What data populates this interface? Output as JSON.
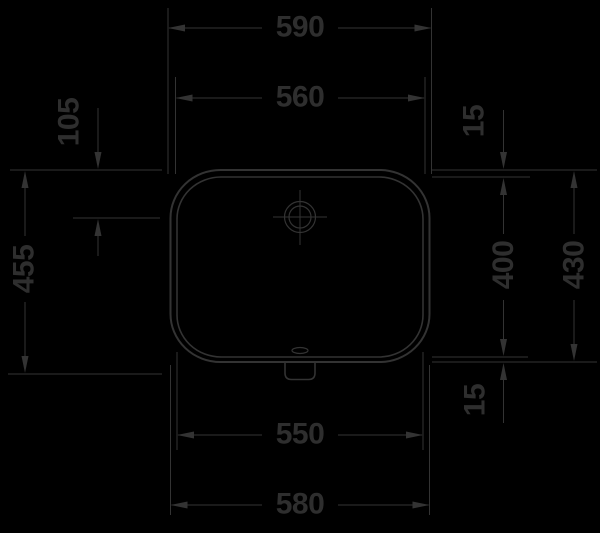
{
  "drawing": {
    "title": "Washbasin plan-view technical dimension drawing",
    "units": "mm",
    "colors": {
      "background": "#000000",
      "line": "#333333",
      "text": "#2e2e2e"
    },
    "labels": {
      "d590": "590",
      "d560": "560",
      "d550": "550",
      "d580": "580",
      "d455": "455",
      "d105": "105",
      "d400": "400",
      "d430": "430",
      "d15_top": "15",
      "d15_bottom": "15"
    },
    "dimensions_mm": {
      "top_width_outer": 590,
      "top_width_inner": 560,
      "bottom_width_inner": 550,
      "bottom_width_outer": 580,
      "left_depth_overall": 455,
      "left_tap_center_offset": 105,
      "right_rim_top": 15,
      "right_depth_inner": 400,
      "right_depth_outer": 430,
      "right_rim_bottom": 15
    },
    "features": [
      "tap-hole with crosshair",
      "overflow slot",
      "drain outlet tab"
    ]
  }
}
